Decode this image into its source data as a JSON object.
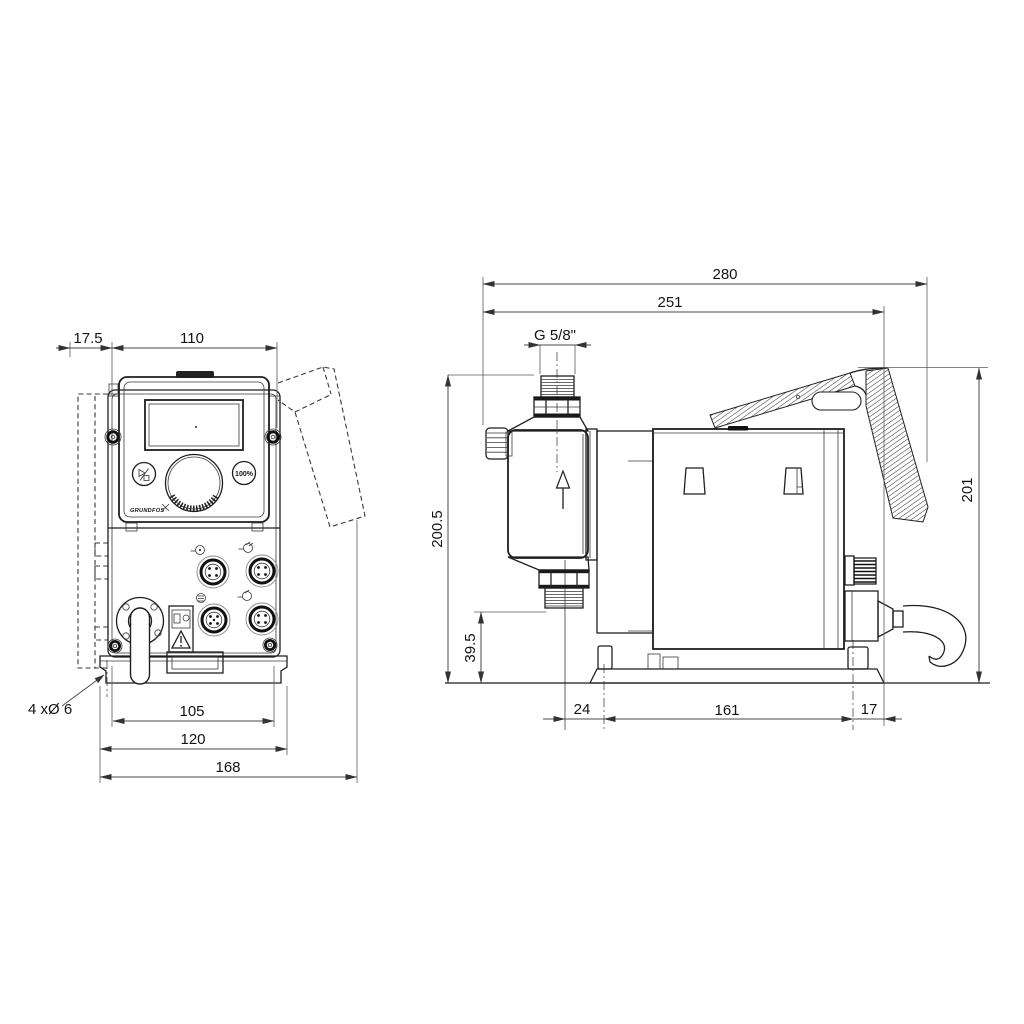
{
  "page": {
    "background": "#ffffff",
    "line_color": "#1f1f1f",
    "drawing_type": "technical-dimension-drawing (dosing pump, front and side views)"
  },
  "front_view": {
    "dims": {
      "bracket_offset": "17.5",
      "width_top": "110",
      "mount_hole_spacing": "105",
      "plate_width": "120",
      "overall_width": "168"
    },
    "mounting_holes_note": "4 xØ 6",
    "control_panel": {
      "brand": "GRUNDFOS",
      "capacity_button_label": "100%"
    }
  },
  "side_view": {
    "dims": {
      "overall_depth": "280",
      "depth_to_base_rear": "251",
      "connection_thread": "G 5/8\"",
      "overall_height": "200.5",
      "valve_clearance": "39.5",
      "front_overhang": "24",
      "base_length": "161",
      "rear_overhang": "17",
      "bracket_height": "201"
    }
  }
}
